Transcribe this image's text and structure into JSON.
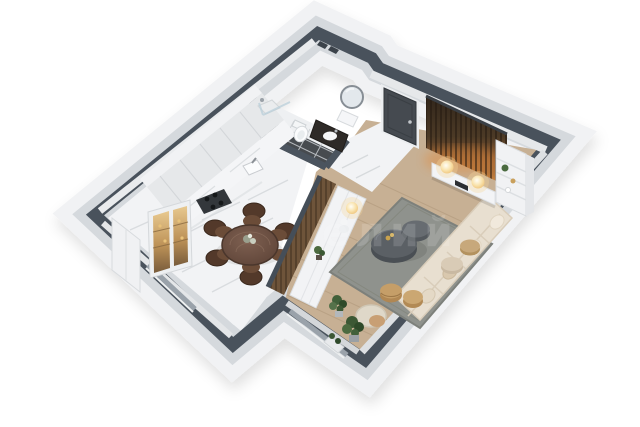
{
  "image": {
    "kind": "3d-isometric-floor-plan-render",
    "background": "#ffffff",
    "view": "top-down isometric perspective of a one-bedroom apartment"
  },
  "watermark": {
    "text": "елий",
    "opacity": "0.14"
  },
  "palette": {
    "wall_top": "#49525c",
    "wall_face": "#d5d9dd",
    "wall_face_light": "#f1f2f4",
    "marble_floor": "#f2f3f5",
    "marble_vein": "#d7dadd",
    "bath_tile": "#474b4f",
    "wood_floor": "#c7b094",
    "rug": "#8f928d",
    "slat_wood_dark": "#3a2d20",
    "slat_glow": "#c8823e",
    "display_cabinet_amber": "#c79a5a",
    "dining_table_wood": "#6d5244",
    "chair_wood": "#4e3827",
    "sofa_cream": "#e8dfd0",
    "wicker": "#c29962",
    "plant_green": "#41603a",
    "door_dark": "#454a50"
  },
  "scene": {
    "style": "isometric-3d-floor-plan",
    "rooms": [
      {
        "name": "Kitchen & Dining",
        "floor": "white marble",
        "items": [
          {
            "label": "kitchen cabinet run",
            "count": 1
          },
          {
            "label": "cooktop",
            "count": 1
          },
          {
            "label": "kitchen sink",
            "count": 1
          },
          {
            "label": "lit display cabinet",
            "count": 1
          },
          {
            "label": "tall white cabinet",
            "count": 1
          },
          {
            "label": "round dining table",
            "count": 1
          },
          {
            "label": "dining chair",
            "count": 6
          },
          {
            "label": "window",
            "count": 1
          }
        ]
      },
      {
        "name": "Bathroom",
        "floor": "dark tile",
        "items": [
          {
            "label": "shower",
            "count": 1
          },
          {
            "label": "toilet",
            "count": 1
          },
          {
            "label": "dark vanity with washbasin",
            "count": 1
          },
          {
            "label": "round mirror",
            "count": 1
          }
        ]
      },
      {
        "name": "Entry Hall",
        "floor": "white marble",
        "items": [
          {
            "label": "entry door",
            "count": 1
          }
        ]
      },
      {
        "name": "Living Room",
        "floor": "light wood",
        "items": [
          {
            "label": "wood slat accent wall",
            "count": 1
          },
          {
            "label": "TV console",
            "count": 1
          },
          {
            "label": "sphere table lamp",
            "count": 2
          },
          {
            "label": "shelving unit",
            "count": 1
          },
          {
            "label": "sectional sofa",
            "count": 1
          },
          {
            "label": "throw pillow",
            "count": 4
          },
          {
            "label": "round coffee table",
            "count": 2
          },
          {
            "label": "area rug",
            "count": 1
          },
          {
            "label": "wicker pouf",
            "count": 3
          },
          {
            "label": "armchair",
            "count": 1
          },
          {
            "label": "floor plant",
            "count": 2
          },
          {
            "label": "slat partition",
            "count": 1
          },
          {
            "label": "sideboard",
            "count": 1
          },
          {
            "label": "bust sculpture",
            "count": 1
          },
          {
            "label": "sideboard lamp",
            "count": 1
          },
          {
            "label": "window",
            "count": 1
          }
        ]
      }
    ]
  }
}
